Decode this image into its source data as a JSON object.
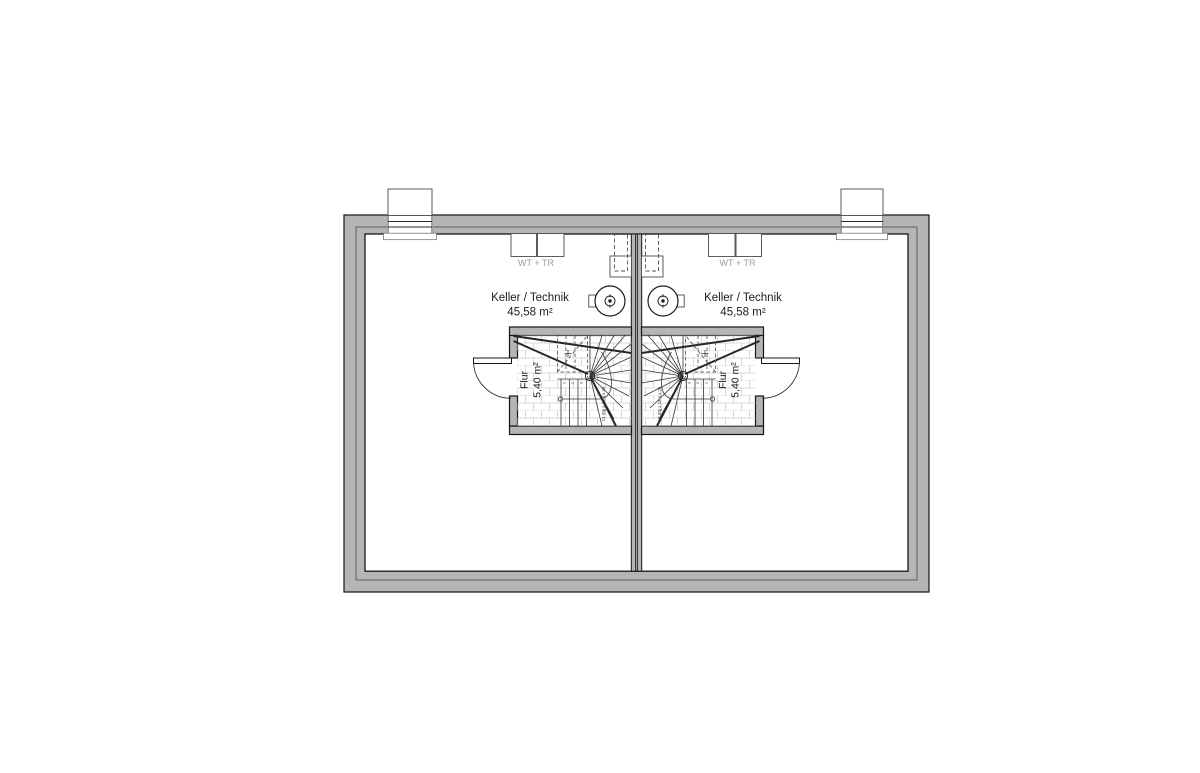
{
  "canvas": {
    "width": 1200,
    "height": 773,
    "background": "#ffffff"
  },
  "colors": {
    "wall_fill": "#b5b5b5",
    "wall_outline": "#161616",
    "stair_line": "#3a3a3a",
    "tile_line": "#cdcdcd",
    "text": "#1c1c1c",
    "muted_text": "#9c9c9c"
  },
  "units": [
    {
      "side": "left",
      "room_label": "Keller / Technik",
      "room_area": "45,58 m²",
      "appliances_label": "WT + TR",
      "hall_label": "Flur",
      "hall_area": "5,40 m²",
      "stair_label": "13 Stg x 18,4 x 25",
      "step_numbers": [
        "1",
        "2",
        "3"
      ]
    },
    {
      "side": "right",
      "room_label": "Keller / Technik",
      "room_area": "45,58 m²",
      "appliances_label": "WT + TR",
      "hall_label": "Flur",
      "hall_area": "5,40 m²",
      "stair_label": "13 Stg x 18,4 x 25",
      "step_numbers": [
        "1",
        "2",
        "3"
      ]
    }
  ]
}
